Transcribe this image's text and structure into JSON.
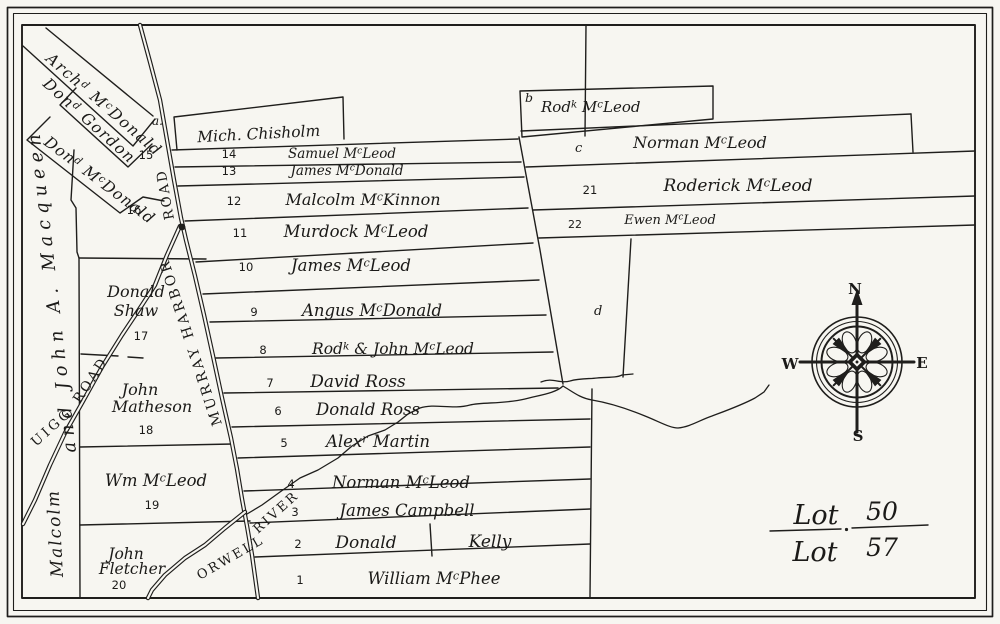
{
  "map": {
    "colors": {
      "ink": "#1f1e1c",
      "paper": "#f7f6f1"
    },
    "compass": {
      "n": "N",
      "e": "E",
      "s": "S",
      "w": "W"
    },
    "lot_label": {
      "top_word": "Lot",
      "top_num": "50",
      "bottom_word": "Lot",
      "bottom_num": "57"
    },
    "roads": {
      "murray_harbor_upper": "ROAD",
      "murray_harbor_lower": "MURRAY HARBOR",
      "uigg_word": "UIGG",
      "uigg_road_word": "ROAD",
      "orwell": "ORWELL",
      "river": "RIVER"
    },
    "edge_labels": {
      "malcolm": "Malcolm",
      "macqueen": "and John A. Macqueen"
    },
    "top_parcel": "Mich. Chisholm",
    "markers": {
      "a": "a.",
      "d": "d"
    },
    "diagonal_parcels": [
      {
        "name": "Arch^d M^cDonald",
        "num": ""
      },
      {
        "name": "Don^d Gordon",
        "num": "15"
      },
      {
        "name": "Don^d M^cDonald",
        "num": "16"
      }
    ],
    "strips": [
      {
        "num": "1",
        "name": "William M^cPhee"
      },
      {
        "num": "2",
        "name": "Donald",
        "name2": "Kelly"
      },
      {
        "num": "3",
        "name": "James Campbell"
      },
      {
        "num": "4",
        "name": "Norman M^cLeod"
      },
      {
        "num": "5",
        "name": "Alex^r Martin"
      },
      {
        "num": "6",
        "name": "Donald Ross"
      },
      {
        "num": "7",
        "name": "David Ross"
      },
      {
        "num": "8",
        "name": "Rod^k & John M^cLeod"
      },
      {
        "num": "9",
        "name": "Angus M^cDonald"
      },
      {
        "num": "10",
        "name": "James M^cLeod"
      },
      {
        "num": "11",
        "name": "Murdock M^cLeod"
      },
      {
        "num": "12",
        "name": "Malcolm M^cKinnon"
      },
      {
        "num": "13",
        "name": "James M^cDonald"
      },
      {
        "num": "14",
        "name": "Samuel M^cLeod"
      }
    ],
    "west_parcels": [
      {
        "name_line1": "Donald",
        "name_line2": "Shaw",
        "num": "17"
      },
      {
        "name_line1": "John",
        "name_line2": "Matheson",
        "num": "18"
      },
      {
        "name_line1": "Wm M^cLeod",
        "name_line2": "",
        "num": "19"
      },
      {
        "name_line1": "John",
        "name_line2": "Fletcher",
        "num": "20"
      }
    ],
    "east_parcels": [
      {
        "id": "b",
        "name": "Rod^k M^cLeod"
      },
      {
        "id": "c",
        "name": "Norman M^cLeod"
      },
      {
        "id": "21",
        "name": "Roderick M^cLeod"
      },
      {
        "id": "22",
        "name": "Ewen M^cLeod"
      }
    ]
  }
}
